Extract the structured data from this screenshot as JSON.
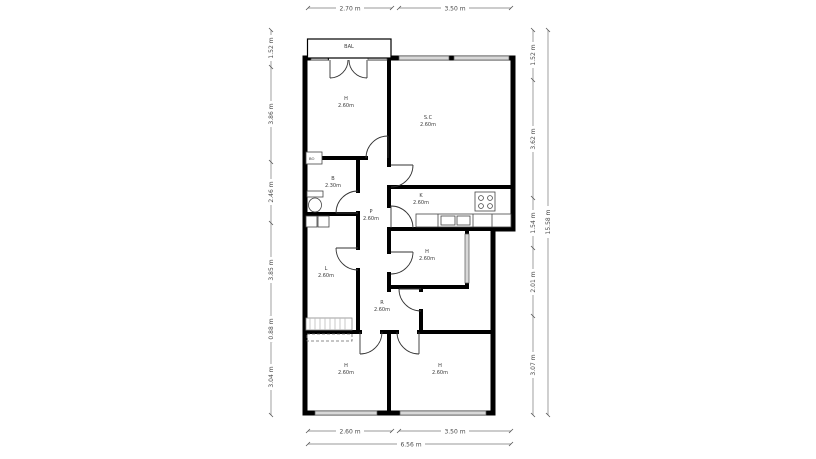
{
  "plan": {
    "balcony_label": "BAL",
    "rooms": {
      "h_top": {
        "abbr": "H",
        "size": "2.60m"
      },
      "sc": {
        "abbr": "S.C",
        "size": "2.60m"
      },
      "b": {
        "abbr": "B",
        "size": "2.30m"
      },
      "p": {
        "abbr": "P",
        "size": "2.60m"
      },
      "k": {
        "abbr": "K",
        "size": "2.60m"
      },
      "h_mid": {
        "abbr": "H",
        "size": "2.60m"
      },
      "l": {
        "abbr": "L",
        "size": "2.60m"
      },
      "r": {
        "abbr": "R",
        "size": "2.60m"
      },
      "h_bottom_left": {
        "abbr": "H",
        "size": "2.60m"
      },
      "h_bottom_right": {
        "abbr": "H",
        "size": "2.60m"
      }
    },
    "fixtures": {
      "boiler_label": "BO"
    }
  },
  "dimensions": {
    "top": [
      "2.70 m",
      "3.50 m"
    ],
    "bottom": [
      "2.60 m",
      "3.50 m"
    ],
    "bottom_total": "6.56 m",
    "left": [
      "1.52 m",
      "3.86 m",
      "2.46 m",
      "3.85 m",
      "0.88 m",
      "3.04 m"
    ],
    "right": [
      "1.52 m",
      "3.62 m",
      "1.54 m",
      "2.01 m",
      "3.07 m"
    ],
    "right_total": "15.58 m"
  },
  "colors": {
    "wall": "#000000",
    "window_fill": "#d8d8d8",
    "dim_line": "#777777",
    "text": "#3a3a3a"
  }
}
